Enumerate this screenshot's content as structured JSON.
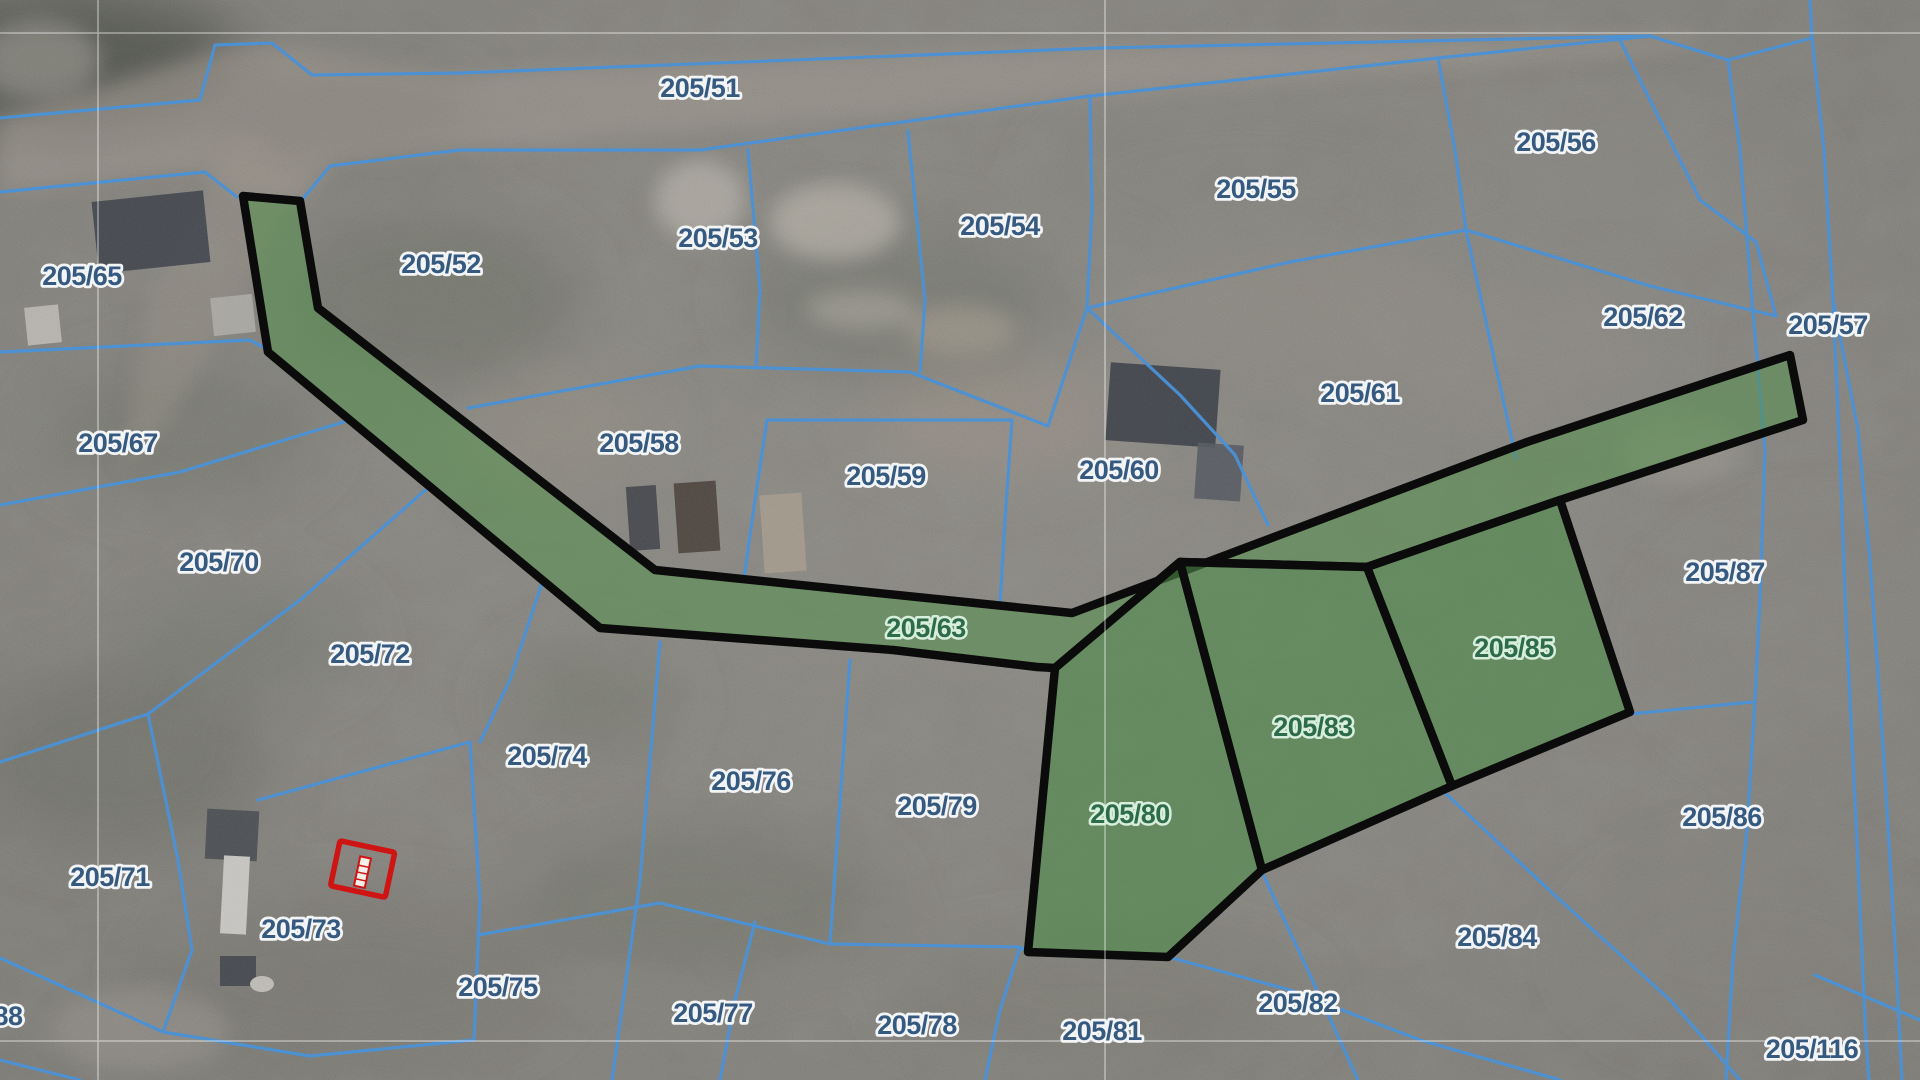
{
  "map": {
    "type": "cadastral-parcel-map",
    "labels": [
      {
        "text": "205/51",
        "x": 700,
        "y": 88,
        "kind": "blue"
      },
      {
        "text": "205/65",
        "x": 82,
        "y": 276,
        "kind": "blue"
      },
      {
        "text": "205/52",
        "x": 441,
        "y": 264,
        "kind": "blue"
      },
      {
        "text": "205/53",
        "x": 718,
        "y": 238,
        "kind": "blue"
      },
      {
        "text": "205/54",
        "x": 1000,
        "y": 226,
        "kind": "blue"
      },
      {
        "text": "205/55",
        "x": 1256,
        "y": 189,
        "kind": "blue"
      },
      {
        "text": "205/56",
        "x": 1556,
        "y": 142,
        "kind": "blue"
      },
      {
        "text": "205/62",
        "x": 1643,
        "y": 317,
        "kind": "blue"
      },
      {
        "text": "205/57",
        "x": 1828,
        "y": 325,
        "kind": "blue"
      },
      {
        "text": "205/67",
        "x": 118,
        "y": 443,
        "kind": "blue"
      },
      {
        "text": "205/58",
        "x": 639,
        "y": 443,
        "kind": "blue"
      },
      {
        "text": "205/59",
        "x": 886,
        "y": 476,
        "kind": "blue"
      },
      {
        "text": "205/60",
        "x": 1119,
        "y": 470,
        "kind": "blue"
      },
      {
        "text": "205/61",
        "x": 1360,
        "y": 393,
        "kind": "blue"
      },
      {
        "text": "205/70",
        "x": 219,
        "y": 562,
        "kind": "blue"
      },
      {
        "text": "205/87",
        "x": 1725,
        "y": 572,
        "kind": "blue"
      },
      {
        "text": "205/72",
        "x": 370,
        "y": 654,
        "kind": "blue"
      },
      {
        "text": "205/74",
        "x": 547,
        "y": 756,
        "kind": "blue"
      },
      {
        "text": "205/76",
        "x": 751,
        "y": 781,
        "kind": "blue"
      },
      {
        "text": "205/79",
        "x": 937,
        "y": 806,
        "kind": "blue"
      },
      {
        "text": "205/86",
        "x": 1722,
        "y": 817,
        "kind": "blue"
      },
      {
        "text": "205/71",
        "x": 110,
        "y": 877,
        "kind": "blue"
      },
      {
        "text": "205/73",
        "x": 301,
        "y": 929,
        "kind": "blue"
      },
      {
        "text": "205/75",
        "x": 498,
        "y": 987,
        "kind": "blue"
      },
      {
        "text": "205/77",
        "x": 713,
        "y": 1013,
        "kind": "blue"
      },
      {
        "text": "205/78",
        "x": 917,
        "y": 1025,
        "kind": "blue"
      },
      {
        "text": "205/81",
        "x": 1102,
        "y": 1031,
        "kind": "blue"
      },
      {
        "text": "205/82",
        "x": 1298,
        "y": 1003,
        "kind": "blue"
      },
      {
        "text": "205/84",
        "x": 1497,
        "y": 937,
        "kind": "blue"
      },
      {
        "text": "205/116",
        "x": 1812,
        "y": 1049,
        "kind": "blue"
      },
      {
        "text": "88",
        "x": 8,
        "y": 1016,
        "kind": "blue"
      },
      {
        "text": "205/63",
        "x": 926,
        "y": 628,
        "kind": "green"
      },
      {
        "text": "205/80",
        "x": 1130,
        "y": 814,
        "kind": "green"
      },
      {
        "text": "205/83",
        "x": 1313,
        "y": 727,
        "kind": "green"
      },
      {
        "text": "205/85",
        "x": 1514,
        "y": 648,
        "kind": "green"
      }
    ],
    "selected_parcels": [
      "205/63",
      "205/80",
      "205/83",
      "205/85"
    ],
    "marker": {
      "type": "building-outline",
      "x": 362,
      "y": 872
    },
    "colors": {
      "parcel_line": "#4a92d8",
      "label_blue": "#35597f",
      "label_green": "#2d6b49",
      "label_halo": "#f2f4f6",
      "label_halo_green": "#d6eedb",
      "selection_fill": "#55924e",
      "selection_border": "#0b0b0b",
      "marker_red": "#cf1414",
      "grid_line": "#ffffff"
    }
  }
}
